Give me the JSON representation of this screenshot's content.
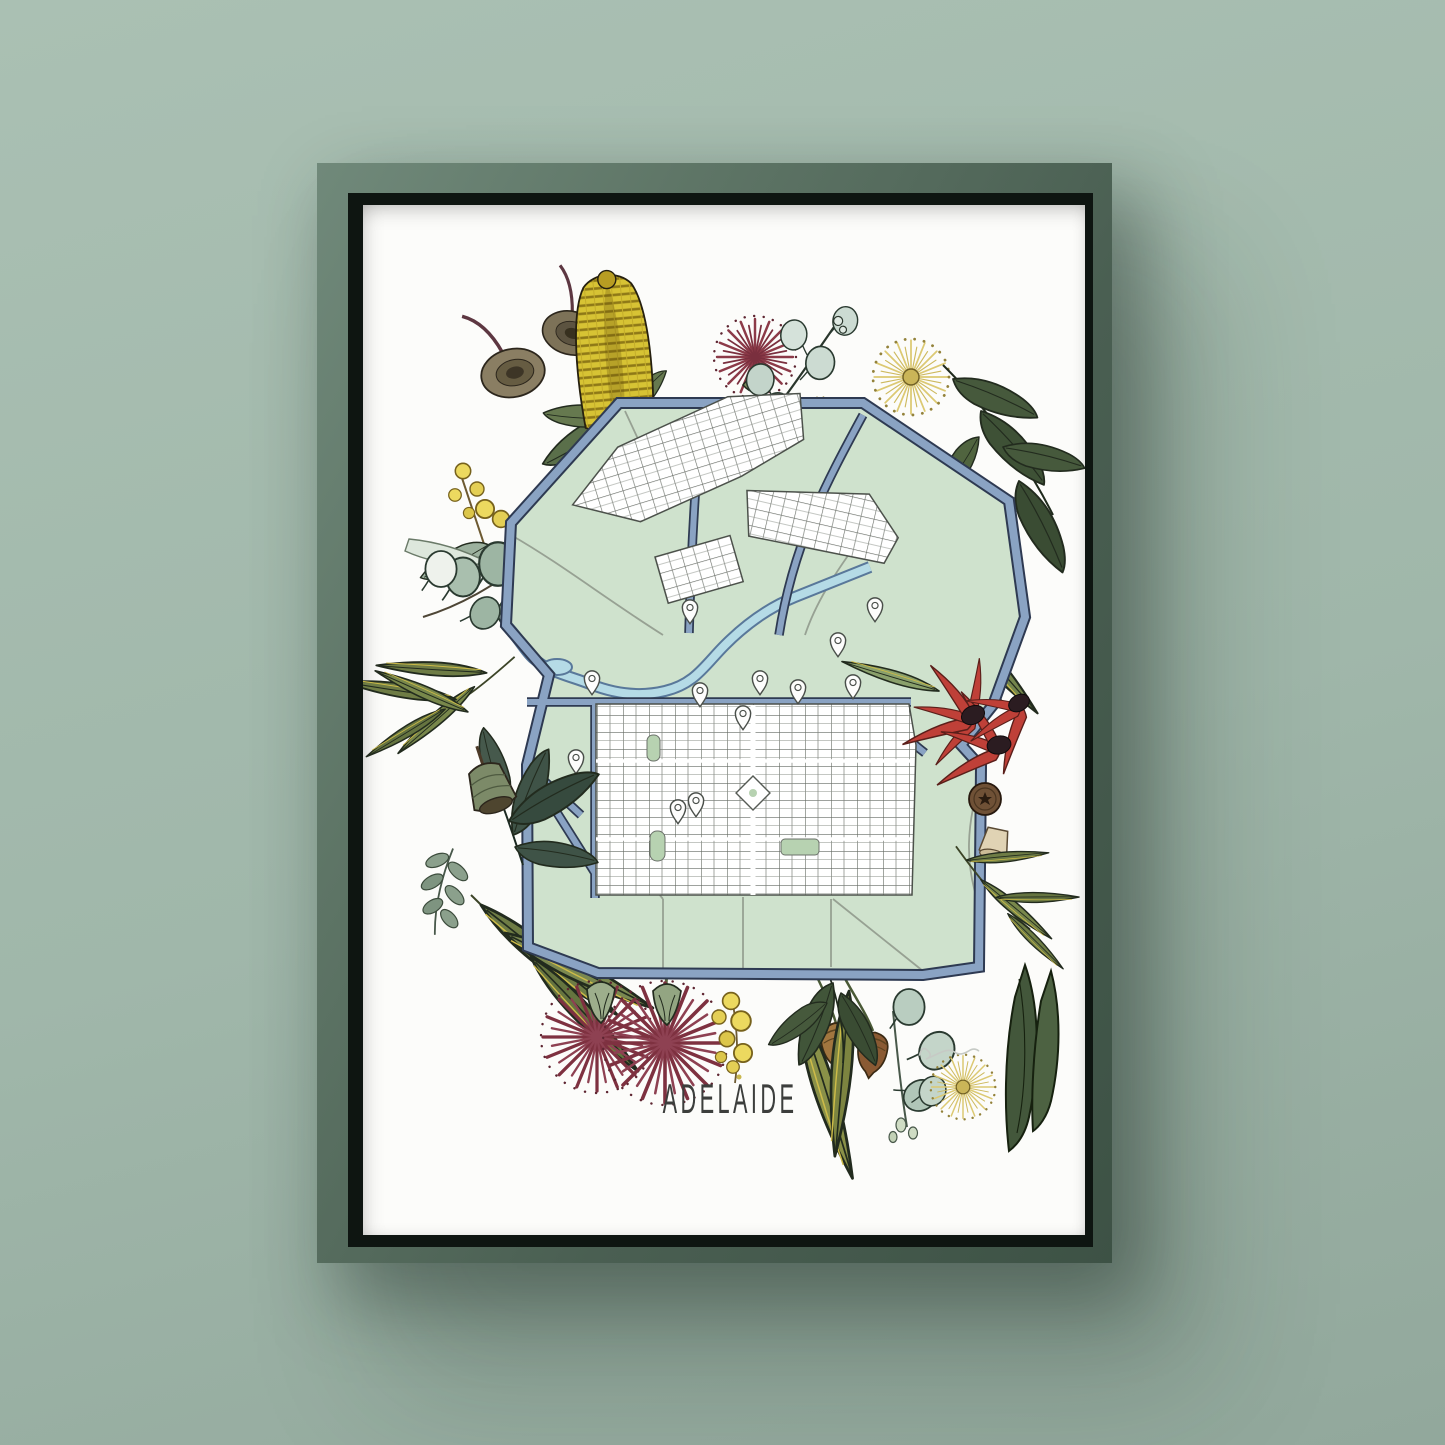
{
  "artwork": {
    "title": "ADELAIDE"
  },
  "palette": {
    "wall": "#a0b7aa",
    "wall_light": "#aac0b3",
    "wall_dark": "#92a89c",
    "frame_green": "#4a5f52",
    "frame_lip": "#0e1511",
    "paper": "#fcfcfa",
    "parkland_green": "#cfe2cd",
    "ring_road_blue": "#8aa3c3",
    "road_casing": "#2e3a52",
    "river_blue": "#b5dbe6",
    "block_white": "#ffffff",
    "block_line_grey": "#656a63",
    "banksia_yellow": "#d7c334",
    "wattle_yellow": "#ecd95f",
    "pompom_cream": "#dcc972",
    "bottlebrush_maroon": "#8c3a48",
    "flowering_gum_maroon": "#7e3140",
    "desert_pea_red": "#bf4038",
    "leaf_dark_green": "#46593c",
    "leaf_olive": "#6e7c45",
    "leaf_silver": "#ccdbd2",
    "gumnut_brown": "#8a7e63",
    "title_ink": "#3c3e3c"
  },
  "map": {
    "city": "Adelaide",
    "features": [
      "park-lands-ring",
      "north-adelaide-street-grid",
      "adelaide-cbd-street-grid",
      "river-torrens",
      "ring-road",
      "victoria-square",
      "city-squares",
      "location-pins"
    ]
  },
  "botanicals": [
    "banksia-flower",
    "gum-nuts",
    "red-bottlebrush",
    "silver-eucalyptus-sprig",
    "billy-button-pompoms",
    "wattle-blossom",
    "eucalyptus-round-leaves",
    "olive-gum-leaves",
    "sturt-desert-pea",
    "star-gum-nut",
    "bell-gum-nut",
    "flowering-gum-blossoms",
    "hanging-gum-nuts",
    "artist-signature"
  ]
}
